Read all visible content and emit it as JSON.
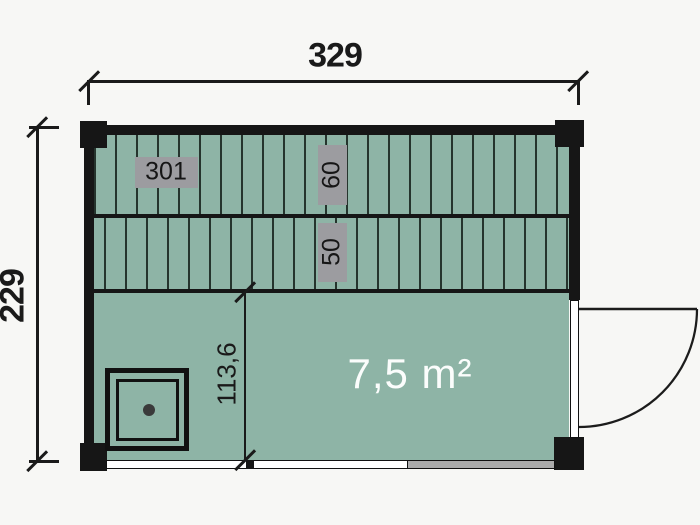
{
  "plan": {
    "outer_width_label": "329",
    "outer_height_label": "229",
    "room_depth_label": "113,6",
    "bench_length_label": "301",
    "bench_depth_upper_label": "60",
    "bench_depth_lower_label": "50",
    "area_label": "7,5 m²"
  },
  "colors": {
    "background": "#f7f7f5",
    "floor_green": "#8eb4a6",
    "plank_line": "#25342d",
    "wall_black": "#161616",
    "badge_gray": "#9c9ca0",
    "threshold_gray": "#ababab",
    "dim_color": "#1a1a1a",
    "area_text": "#fbfdfc"
  }
}
